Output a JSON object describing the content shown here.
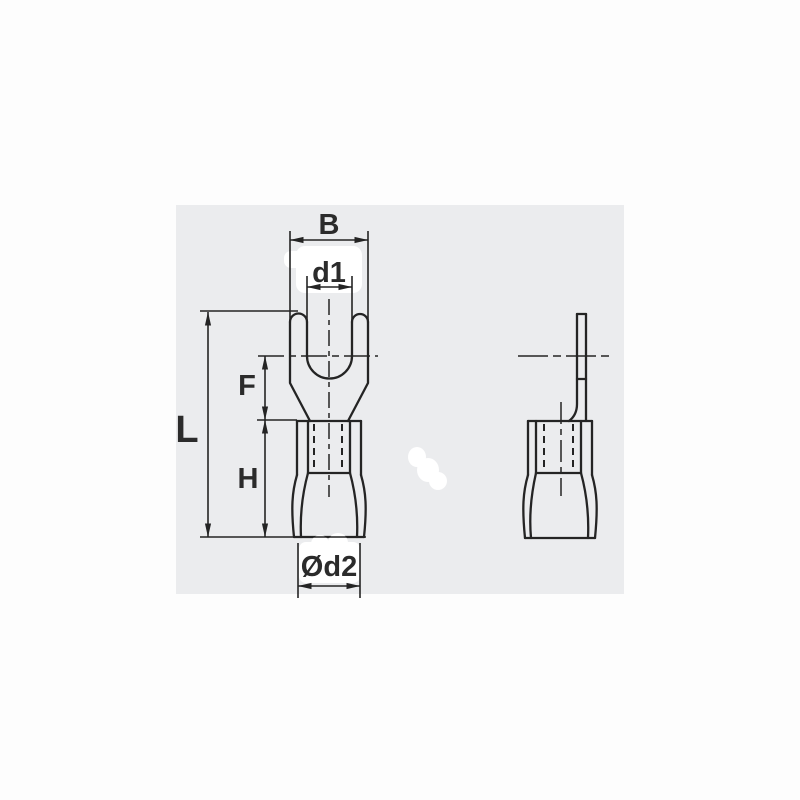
{
  "labels": {
    "b": "B",
    "d1": "d1",
    "f": "F",
    "l": "L",
    "h": "H",
    "od2": "Ød2"
  },
  "colors": {
    "page": "#fdfdfd",
    "paper": "#ebecee",
    "line": "#242424",
    "text": "#2b2b2b",
    "patch": "#ffffff"
  }
}
